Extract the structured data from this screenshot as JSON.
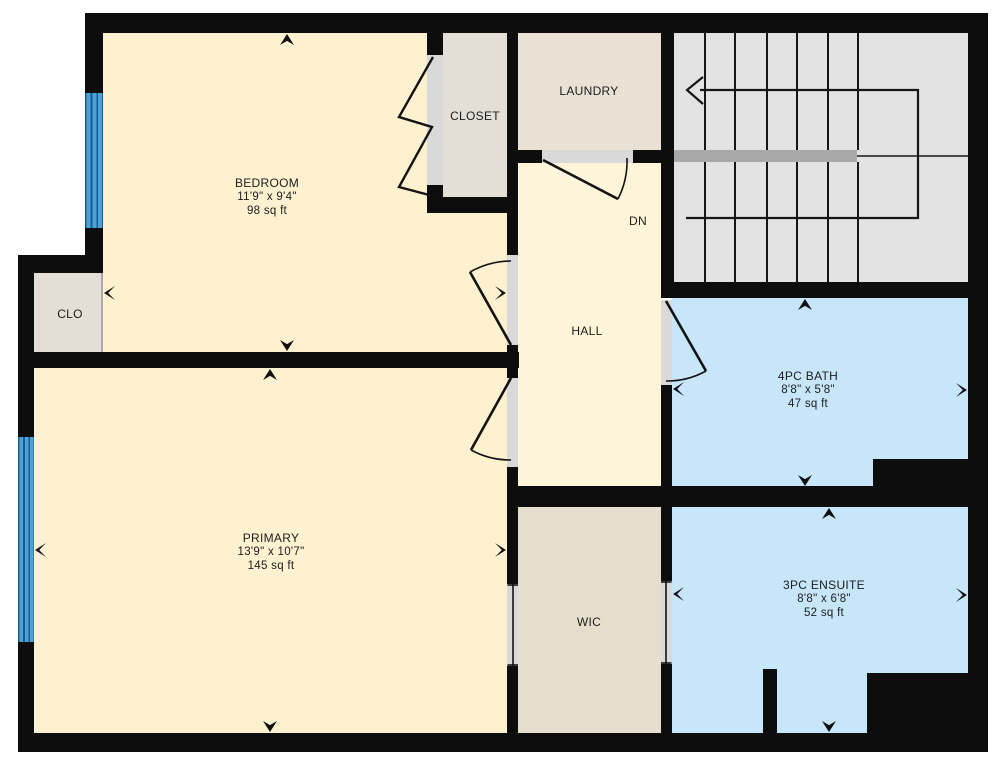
{
  "plan": {
    "type_label": "floor-plan",
    "rooms": {
      "bedroom": {
        "name": "BEDROOM",
        "dims": "11'9\" x 9'4\"",
        "area": "98 sq ft"
      },
      "closet": {
        "name": "CLOSET"
      },
      "laundry": {
        "name": "LAUNDRY"
      },
      "clo": {
        "name": "CLO"
      },
      "hall": {
        "name": "HALL"
      },
      "stairs": {
        "direction_label": "DN"
      },
      "primary": {
        "name": "PRIMARY",
        "dims": "13'9\" x 10'7\"",
        "area": "145 sq ft"
      },
      "wic": {
        "name": "WIC"
      },
      "bath": {
        "name": "4PC BATH",
        "dims": "8'8\" x 5'8\"",
        "area": "47 sq ft"
      },
      "ensuite": {
        "name": "3PC ENSUITE",
        "dims": "8'8\" x 6'8\"",
        "area": "52 sq ft"
      }
    },
    "palette": {
      "wall": "#0d0d0d",
      "bedroom_fill": "#fdf1cf",
      "primary_fill": "#fdf1cf",
      "hall_fill": "#fdf4da",
      "closet_fill": "#e4dfd6",
      "clo_fill": "#e4dfd6",
      "laundry_fill": "#e9e1d3",
      "wic_fill": "#e6decd",
      "bath_fill": "#c7e6fa",
      "ensuite_fill": "#c7e6fa",
      "stairs_fill": "#e3e3e3",
      "railing": "#a9a9a9",
      "threshold": "#d9d9d9",
      "window_glass": "#4ba1d8",
      "window_frame": "#1d5c8c",
      "line": "#161616"
    }
  }
}
